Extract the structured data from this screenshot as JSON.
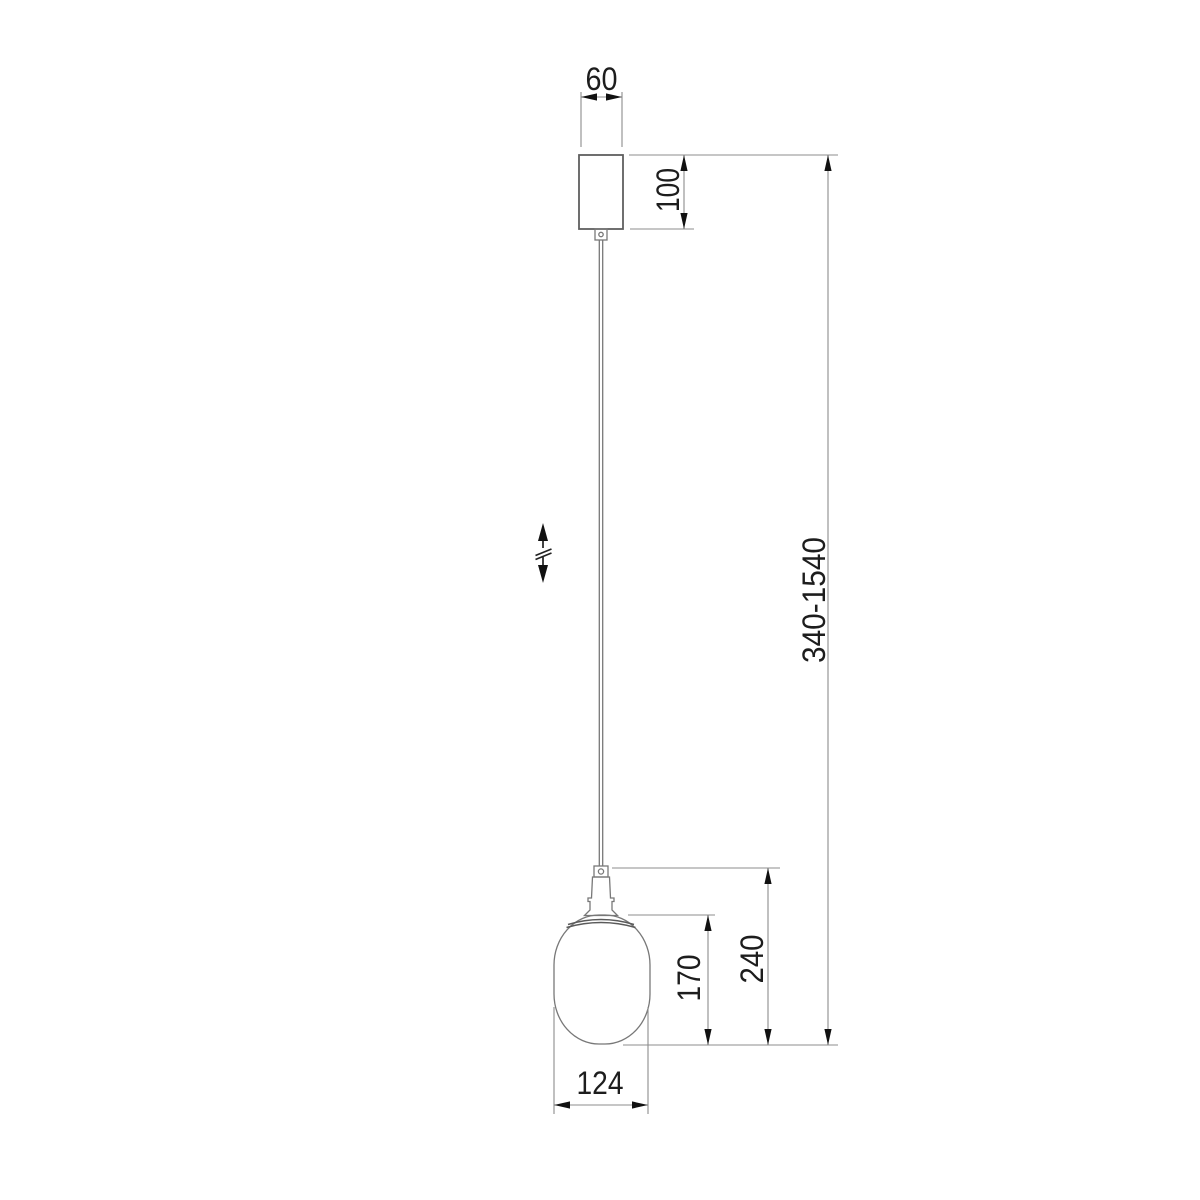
{
  "drawing": {
    "kind": "pendant-light-dimension-drawing",
    "units_note": ""
  },
  "dimensions": {
    "canopy_width": "60",
    "canopy_height": "100",
    "suspension_height_range": "340-1540",
    "shade_height": "170",
    "fixture_height": "240",
    "shade_width": "124"
  },
  "icons": {
    "height_adjustment_icon": "double-arrow-with-break"
  },
  "colors": {
    "background": "#ffffff",
    "object_outline": "#5f5f5f",
    "dimension_line": "#8c8c8c",
    "arrowhead": "#111111",
    "text": "#1d1d1d"
  }
}
